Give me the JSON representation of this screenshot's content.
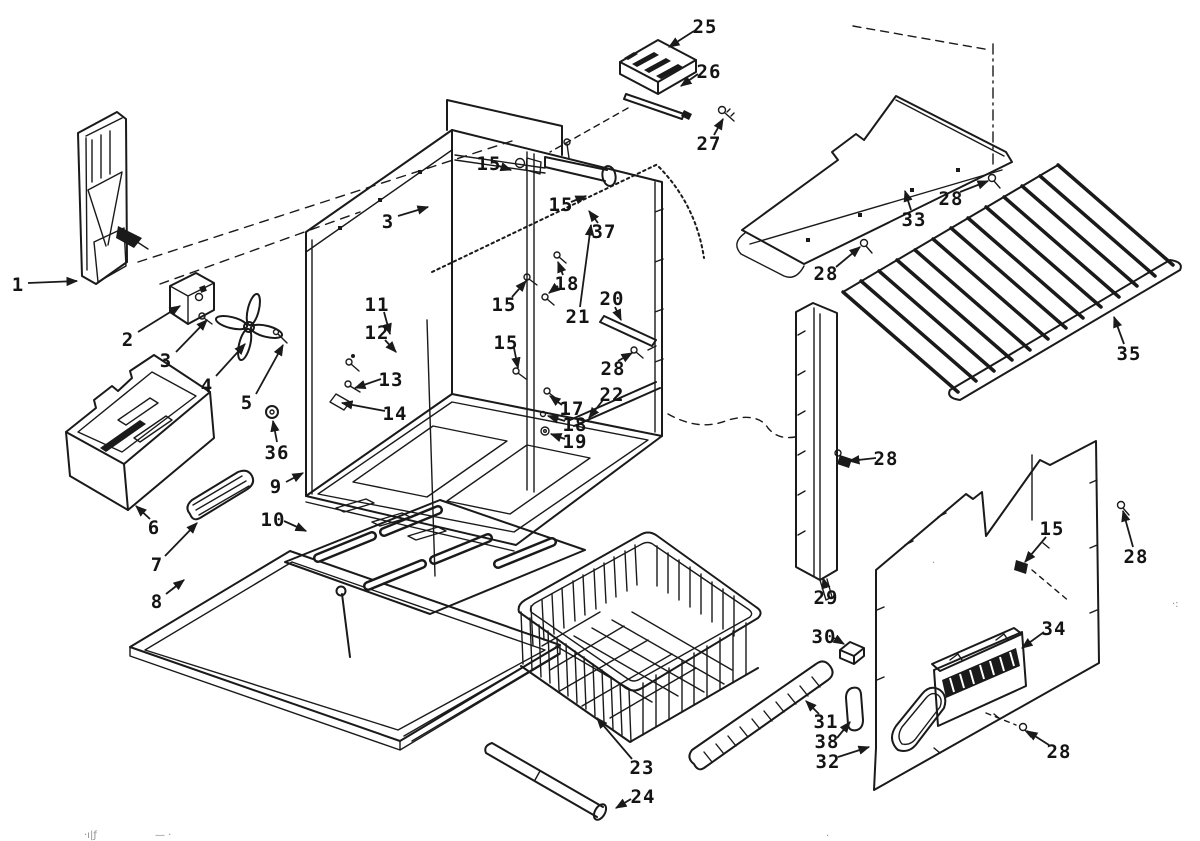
{
  "canvas": {
    "ink_color": "#1a1a1a",
    "paper_color": "#ffffff"
  },
  "callouts": [
    {
      "text": "1",
      "x": 18,
      "y": 284,
      "leaders": [
        [
          28,
          283,
          77,
          281
        ]
      ]
    },
    {
      "text": "2",
      "x": 128,
      "y": 339,
      "leaders": [
        [
          138,
          332,
          180,
          306
        ]
      ]
    },
    {
      "text": "3",
      "x": 166,
      "y": 360,
      "leaders": [
        [
          176,
          352,
          207,
          320
        ]
      ]
    },
    {
      "text": "4",
      "x": 207,
      "y": 385,
      "leaders": [
        [
          216,
          376,
          245,
          344
        ]
      ]
    },
    {
      "text": "5",
      "x": 247,
      "y": 402,
      "leaders": [
        [
          256,
          394,
          283,
          345
        ]
      ]
    },
    {
      "text": "36",
      "x": 277,
      "y": 452,
      "leaders": [
        [
          277,
          442,
          273,
          421
        ]
      ]
    },
    {
      "text": "6",
      "x": 154,
      "y": 527,
      "leaders": [
        [
          150,
          519,
          136,
          506
        ]
      ]
    },
    {
      "text": "7",
      "x": 157,
      "y": 564,
      "leaders": [
        [
          165,
          556,
          197,
          523
        ]
      ]
    },
    {
      "text": "8",
      "x": 157,
      "y": 601,
      "leaders": [
        [
          166,
          594,
          184,
          580
        ]
      ]
    },
    {
      "text": "9",
      "x": 276,
      "y": 486,
      "leaders": [
        [
          286,
          482,
          303,
          473
        ]
      ]
    },
    {
      "text": "10",
      "x": 273,
      "y": 519,
      "leaders": [
        [
          284,
          521,
          306,
          531
        ]
      ]
    },
    {
      "text": "11",
      "x": 377,
      "y": 304,
      "leaders": [
        [
          384,
          312,
          390,
          334
        ]
      ]
    },
    {
      "text": "12",
      "x": 377,
      "y": 332,
      "leaders": [
        [
          385,
          340,
          396,
          352
        ]
      ]
    },
    {
      "text": "13",
      "x": 391,
      "y": 379,
      "leaders": [
        [
          381,
          379,
          355,
          388
        ]
      ]
    },
    {
      "text": "14",
      "x": 395,
      "y": 413,
      "leaders": [
        [
          385,
          411,
          342,
          403
        ]
      ]
    },
    {
      "text": "3",
      "x": 388,
      "y": 221,
      "leaders": [
        [
          398,
          216,
          428,
          207
        ]
      ]
    },
    {
      "text": "15",
      "x": 489,
      "y": 163,
      "leaders": [
        [
          499,
          166,
          511,
          170
        ]
      ]
    },
    {
      "text": "15",
      "x": 561,
      "y": 204,
      "leaders": [
        [
          571,
          202,
          586,
          196
        ]
      ]
    },
    {
      "text": "15",
      "x": 504,
      "y": 304,
      "leaders": [
        [
          512,
          297,
          526,
          281
        ]
      ]
    },
    {
      "text": "15",
      "x": 506,
      "y": 342,
      "leaders": [
        [
          514,
          348,
          518,
          368
        ]
      ]
    },
    {
      "text": "37",
      "x": 604,
      "y": 231,
      "leaders": [
        [
          598,
          223,
          589,
          211
        ]
      ]
    },
    {
      "text": "18",
      "x": 567,
      "y": 283,
      "leaders": [
        [
          563,
          275,
          558,
          262
        ],
        [
          558,
          286,
          549,
          293
        ]
      ]
    },
    {
      "text": "20",
      "x": 612,
      "y": 298,
      "leaders": [
        [
          615,
          307,
          621,
          320
        ]
      ]
    },
    {
      "text": "21",
      "x": 578,
      "y": 316,
      "leaders": [
        [
          580,
          307,
          591,
          225
        ]
      ]
    },
    {
      "text": "17",
      "x": 572,
      "y": 408,
      "leaders": [
        [
          562,
          405,
          550,
          396
        ]
      ]
    },
    {
      "text": "18",
      "x": 575,
      "y": 424,
      "leaders": [
        [
          565,
          421,
          548,
          416
        ]
      ]
    },
    {
      "text": "19",
      "x": 575,
      "y": 441,
      "leaders": [
        [
          565,
          439,
          551,
          434
        ]
      ]
    },
    {
      "text": "22",
      "x": 612,
      "y": 394,
      "leaders": [
        [
          603,
          400,
          589,
          418
        ]
      ]
    },
    {
      "text": "28",
      "x": 613,
      "y": 368,
      "leaders": [
        [
          618,
          361,
          632,
          353
        ]
      ]
    },
    {
      "text": "23",
      "x": 642,
      "y": 767,
      "leaders": [
        [
          632,
          759,
          597,
          718
        ]
      ]
    },
    {
      "text": "24",
      "x": 643,
      "y": 796,
      "leaders": [
        [
          631,
          799,
          616,
          808
        ]
      ]
    },
    {
      "text": "25",
      "x": 705,
      "y": 26,
      "leaders": [
        [
          694,
          31,
          669,
          47
        ]
      ]
    },
    {
      "text": "26",
      "x": 709,
      "y": 71,
      "leaders": [
        [
          698,
          74,
          681,
          86
        ]
      ]
    },
    {
      "text": "27",
      "x": 709,
      "y": 143,
      "leaders": [
        [
          714,
          135,
          723,
          119
        ]
      ]
    },
    {
      "text": "28",
      "x": 951,
      "y": 198,
      "leaders": [
        [
          960,
          192,
          988,
          181
        ]
      ]
    },
    {
      "text": "33",
      "x": 914,
      "y": 219,
      "leaders": [
        [
          911,
          210,
          905,
          191
        ]
      ]
    },
    {
      "text": "28",
      "x": 826,
      "y": 273,
      "leaders": [
        [
          836,
          267,
          860,
          247
        ]
      ]
    },
    {
      "text": "35",
      "x": 1129,
      "y": 353,
      "leaders": [
        [
          1124,
          344,
          1114,
          317
        ]
      ]
    },
    {
      "text": "28",
      "x": 886,
      "y": 458,
      "leaders": [
        [
          876,
          458,
          849,
          461
        ]
      ]
    },
    {
      "text": "15",
      "x": 1052,
      "y": 528,
      "leaders": [
        [
          1046,
          537,
          1025,
          562
        ]
      ]
    },
    {
      "text": "28",
      "x": 1136,
      "y": 556,
      "leaders": [
        [
          1133,
          547,
          1123,
          511
        ]
      ]
    },
    {
      "text": "29",
      "x": 826,
      "y": 597,
      "leaders": [
        [
          826,
          588,
          823,
          578
        ]
      ]
    },
    {
      "text": "30",
      "x": 824,
      "y": 636,
      "leaders": [
        [
          834,
          638,
          844,
          644
        ]
      ]
    },
    {
      "text": "34",
      "x": 1054,
      "y": 628,
      "leaders": [
        [
          1044,
          632,
          1022,
          648
        ]
      ]
    },
    {
      "text": "31",
      "x": 826,
      "y": 721,
      "leaders": [
        [
          819,
          714,
          806,
          701
        ]
      ]
    },
    {
      "text": "38",
      "x": 827,
      "y": 741,
      "leaders": [
        [
          837,
          738,
          850,
          722
        ]
      ]
    },
    {
      "text": "32",
      "x": 828,
      "y": 761,
      "leaders": [
        [
          838,
          757,
          869,
          747
        ]
      ]
    },
    {
      "text": "28",
      "x": 1059,
      "y": 751,
      "leaders": [
        [
          1049,
          745,
          1027,
          731
        ]
      ]
    }
  ],
  "scan_artifacts": [
    {
      "text": "·ı|ƒ",
      "x": 84,
      "y": 838
    },
    {
      "text": "— ·",
      "x": 155,
      "y": 838
    },
    {
      "text": "·",
      "x": 826,
      "y": 839
    },
    {
      "text": "·:",
      "x": 1172,
      "y": 607
    },
    {
      "text": "·",
      "x": 932,
      "y": 566
    }
  ]
}
